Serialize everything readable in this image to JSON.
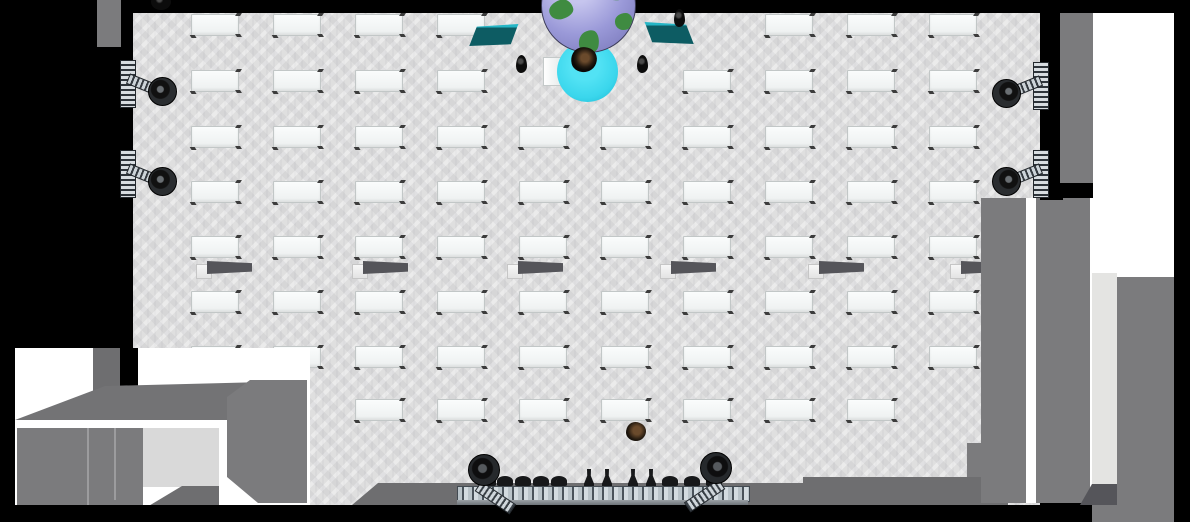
{
  "scene": {
    "colors": {
      "black": "#000000",
      "white": "#ffffff",
      "floor": "#dfdfdf",
      "floorPatch": "#d9d9d9",
      "wallGray": "#7b7b7d",
      "wallMid": "#6e6e70",
      "wallDark": "#55555a",
      "roofGray": "#737375",
      "seam": "#9c9c9e",
      "brick": "#e4e4e2",
      "deskFill": "#f4f7f7",
      "deskEdge": "#c2c7c7",
      "deskLeg": "#3c3c3c",
      "teal": "#0d5c63",
      "tealEdge": "#25b6c6",
      "globeSea": "#9a99d8",
      "globeLand": "#3f8b41",
      "stageCircle": "#3ad6ec",
      "truss": "#c3ccd2",
      "fixture": "#17181a",
      "plantBlack": "#101010",
      "avatarDark": "#241a10"
    },
    "desks": {
      "cols": [
        191,
        273,
        355,
        437,
        519,
        601,
        683,
        765,
        847,
        929
      ],
      "rows": [
        14,
        70,
        126,
        181,
        236,
        291,
        346,
        399
      ],
      "w": 46,
      "h": 20,
      "omit": [
        "0-4",
        "0-5",
        "0-6",
        "1-4",
        "1-5",
        "7-0",
        "7-1",
        "7-9"
      ]
    },
    "benches": {
      "y": 261,
      "xs": [
        196,
        352,
        507,
        660,
        808,
        950
      ]
    },
    "plants": [
      {
        "x": 516,
        "y": 55
      },
      {
        "x": 637,
        "y": 55
      },
      {
        "x": 674,
        "y": 9
      },
      {
        "x": 151,
        "y": -6,
        "round": true
      }
    ],
    "wall_spotlights": [
      {
        "x": 112,
        "y": 60,
        "side": "left"
      },
      {
        "x": 112,
        "y": 150,
        "side": "left"
      },
      {
        "x": 995,
        "y": 62,
        "side": "right"
      },
      {
        "x": 995,
        "y": 150,
        "side": "right"
      }
    ],
    "top_stage": {
      "globe": {
        "x": 541,
        "y": -42,
        "d": 93
      },
      "circle": {
        "x": 557,
        "y": 41,
        "d": 61
      },
      "podium": {
        "x": 543,
        "y": 57,
        "w": 17,
        "h": 27
      },
      "presenter": {
        "x": 571,
        "y": 47,
        "w": 26,
        "h": 25
      },
      "screens": [
        {
          "x": 466,
          "y": 24,
          "w": 54,
          "h": 22,
          "side": "left"
        },
        {
          "x": 643,
          "y": 22,
          "w": 54,
          "h": 22,
          "side": "right"
        }
      ]
    },
    "attendee": {
      "x": 626,
      "y": 422,
      "w": 20,
      "h": 19
    },
    "stage": {
      "truss": {
        "x": 457,
        "y": 486,
        "w": 291,
        "h": 14
      },
      "fixture_y": 476,
      "fixtures": [
        {
          "t": "dome",
          "x": 480
        },
        {
          "t": "dome",
          "x": 497
        },
        {
          "t": "dome",
          "x": 515
        },
        {
          "t": "dome",
          "x": 533
        },
        {
          "t": "dome",
          "x": 551
        },
        {
          "t": "bottle",
          "x": 584
        },
        {
          "t": "bottle",
          "x": 602
        },
        {
          "t": "bottle",
          "x": 628
        },
        {
          "t": "bottle",
          "x": 646
        },
        {
          "t": "dome",
          "x": 662
        },
        {
          "t": "dome",
          "x": 684
        },
        {
          "t": "dome",
          "x": 706
        }
      ],
      "end_lights": [
        {
          "x": 468,
          "y": 454,
          "side": "left"
        },
        {
          "x": 662,
          "y": 452,
          "side": "right"
        }
      ]
    },
    "structures": [
      {
        "n": "top-wall-band",
        "f": "black",
        "p": "0,0 1174,0 1174,13 0,13"
      },
      {
        "n": "left-wall-band",
        "f": "black",
        "p": "0,0 133,0 133,352 0,352"
      },
      {
        "n": "left-outer-wall-patch",
        "f": "wallGray",
        "p": "97,0 121,0 121,47 97,47"
      },
      {
        "n": "left-edge-strip",
        "f": "black",
        "p": "0,352 15,352 15,522 0,522"
      },
      {
        "n": "bottom-left-backdrop",
        "f": "white",
        "p": "15,348 310,348 310,507 15,507"
      },
      {
        "n": "bottom-left-notch-slab",
        "f": "wallMid",
        "p": "93,348 120,348 120,398 93,398"
      },
      {
        "n": "bottom-left-wall-strip",
        "f": "black",
        "p": "120,348 138,348 138,393 120,393"
      },
      {
        "n": "bottom-left-roof",
        "f": "roofGray",
        "p": "15,420 105,386 307,381 307,422"
      },
      {
        "n": "bottom-left-white-band",
        "f": "white",
        "p": "15,420 307,420 307,429 15,429"
      },
      {
        "n": "bottom-left-panel-block",
        "f": "wallGray",
        "p": "17,428 143,428 143,506 17,506"
      },
      {
        "n": "panel-seam",
        "f": "seam",
        "p": "87,428 89,428 89,506 87,506"
      },
      {
        "n": "panel-seam",
        "f": "seam",
        "p": "114,428 116,428 116,500 114,500"
      },
      {
        "n": "bottom-left-floor-patch",
        "f": "floorPatch",
        "p": "143,428 222,428 222,487 143,487"
      },
      {
        "n": "bottom-left-angled-step",
        "f": "wallMid",
        "p": "147,507 222,507 222,486 182,486"
      },
      {
        "n": "bottom-left-white-strip",
        "f": "white",
        "p": "219,420 227,420 227,507 219,507"
      },
      {
        "n": "bottom-left-big-slab",
        "f": "wallGray",
        "p": "227,397 250,380 307,380 307,503 258,503 227,477"
      },
      {
        "n": "stage-right-block",
        "f": "wallGray",
        "p": "967,443 1008,443 1008,505 967,505"
      },
      {
        "n": "stage-step",
        "f": "wallMid",
        "p": "803,477 1008,477 1008,485 803,485"
      },
      {
        "n": "stage-platform",
        "f": "wallMid",
        "p": "352,505 378,483 1008,483 1008,505"
      },
      {
        "n": "right-wall-slab-a",
        "f": "wallGray",
        "p": "981,198 1026,198 1026,503 981,503"
      },
      {
        "n": "right-gap-a",
        "f": "white",
        "p": "1026,198 1036,198 1036,503 1026,503"
      },
      {
        "n": "right-wall-slab-b",
        "f": "wallGray",
        "p": "1036,198 1090,198 1090,503 1036,503"
      },
      {
        "n": "right-gap-b",
        "f": "white",
        "p": "1090,198 1093,198 1093,503 1090,503"
      },
      {
        "n": "right-wall-strip",
        "f": "black",
        "p": "1040,10 1063,10 1063,200 1040,200"
      },
      {
        "n": "right-outer-wall",
        "f": "wallGray",
        "p": "1060,13 1093,13 1093,183 1060,183"
      },
      {
        "n": "right-white-region",
        "f": "white",
        "p": "1093,13 1174,13 1174,522 1093,522"
      },
      {
        "n": "brick-strip",
        "f": "brick",
        "p": "1092,273 1117,273 1117,490 1092,490"
      },
      {
        "n": "brick-foot",
        "f": "wallDark",
        "p": "1080,505 1092,484 1117,484 1117,505"
      },
      {
        "n": "right-wall-slab-c",
        "f": "wallGray",
        "p": "1117,277 1177,277 1177,505 1117,505"
      },
      {
        "n": "bottom-right-gray",
        "f": "wallGray",
        "p": "1092,505 1177,505 1177,522 1092,522"
      },
      {
        "n": "bottom-wall-band",
        "f": "black",
        "p": "0,505 1092,505 1092,522 0,522"
      },
      {
        "n": "right-edge-band",
        "f": "black",
        "p": "1174,0 1190,0 1190,522 1174,522"
      }
    ]
  }
}
